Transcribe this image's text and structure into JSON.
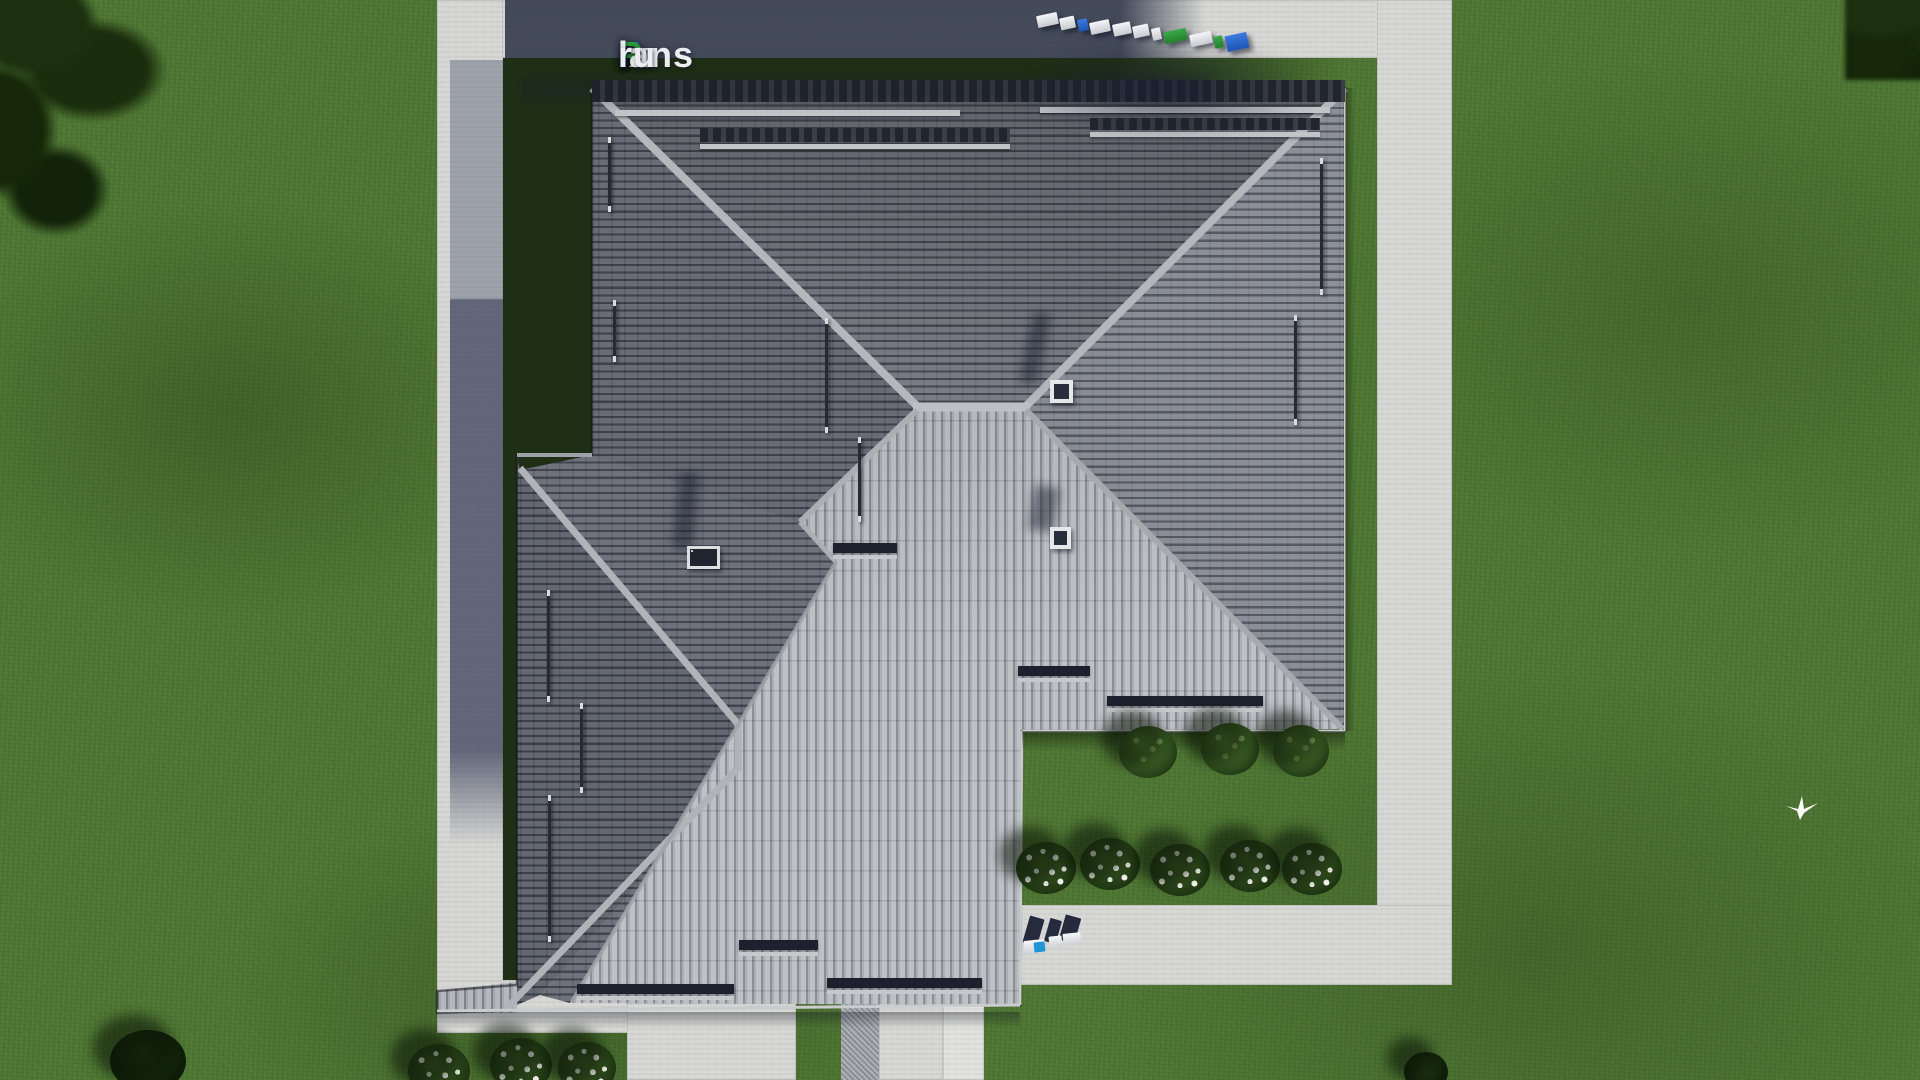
{
  "meta": {
    "title": "FixPlans.ru — aerial top-down 3D render of a house hip roof plan"
  },
  "watermark": {
    "logo": {
      "full_text": "FixPlans.ru",
      "segments": [
        {
          "text": "F",
          "color": "#2f6fd6"
        },
        {
          "text": "ix",
          "color": "#eceef1"
        },
        {
          "text": "P",
          "color": "#2fa03c"
        },
        {
          "text": "lans",
          "color": "#eceef1"
        },
        {
          "text": ".",
          "color": "#2f6fd6"
        },
        {
          "text": "ru",
          "color": "#eceef1"
        }
      ]
    },
    "roof_blocks_text": "FixPlans.ru",
    "ground_text": ".ru"
  },
  "scene": {
    "elements": [
      "gray tiled hip roof",
      "two chimney vents",
      "pair of roof windows",
      "snow-guard bars and roof ladders",
      "concrete walkway ring",
      "front entrance walkway",
      "driveway with granite strip",
      "lawn",
      "three green shrubs",
      "rows of white flower bushes",
      "dark tree canopy corners",
      "white flying bird",
      "building shadow cast to upper left"
    ],
    "palette": {
      "grass": "#4c7431",
      "grass_shadow": "#1f2f15",
      "path": "#d6d6d4",
      "path_shadow": "#5c657e",
      "roof_dark": "#565a63",
      "roof_mid": "#7c808a",
      "roof_light": "#8e929c",
      "roof_bright": "#b3b6bc",
      "ridge": "#b4b7bb",
      "accent_blue": "#2f6fd6",
      "accent_green": "#2fa03c"
    }
  }
}
